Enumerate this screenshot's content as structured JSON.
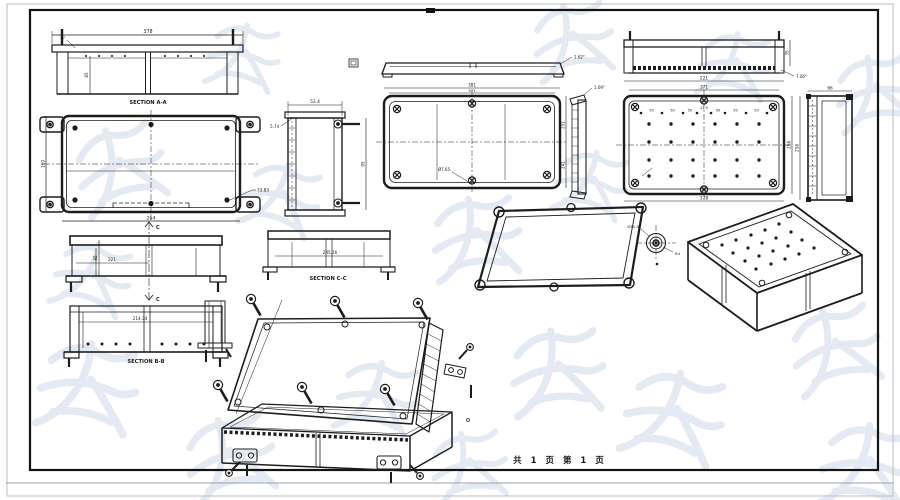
{
  "sheet": {
    "footer": "共 1 页  第 1 页",
    "line_color": "#1c1c1c",
    "watermark_color": "#ccd9ea",
    "background": "#ffffff"
  },
  "views": {
    "section_aa": {
      "label": "SECTION A-A",
      "width": "378",
      "flange": "17",
      "depth": "85"
    },
    "base_top": {
      "width": "264",
      "height": "160",
      "offset": "73.83"
    },
    "elevation_c": {
      "width": "221",
      "inner": "85",
      "cut_label": "C"
    },
    "section_bb": {
      "label": "SECTION B-B",
      "width": "214.34"
    },
    "side_left": {
      "width": "53.4",
      "lip": "5.74",
      "height": "95"
    },
    "lid_profile": {
      "angle": "1.62°"
    },
    "lid_top": {
      "width": "381",
      "inner_width": "371",
      "height": "251",
      "inner_height": "241",
      "hole": "Ø7.65"
    },
    "lid_section": {
      "width": "221",
      "height": "35",
      "angle": "7.06°"
    },
    "bottom_view": {
      "inner_width": "371",
      "width": "378",
      "height": "258",
      "hole_spacing": "50",
      "center_gap": "21.5"
    },
    "side_right": {
      "width": "66",
      "height": "258"
    },
    "lid_side": {
      "angle": "1.09°"
    },
    "section_cc": {
      "label": "SECTION C-C",
      "width": "245.16"
    },
    "screw_detail": {
      "dia": "Ø10.5",
      "radius": "R4"
    }
  }
}
